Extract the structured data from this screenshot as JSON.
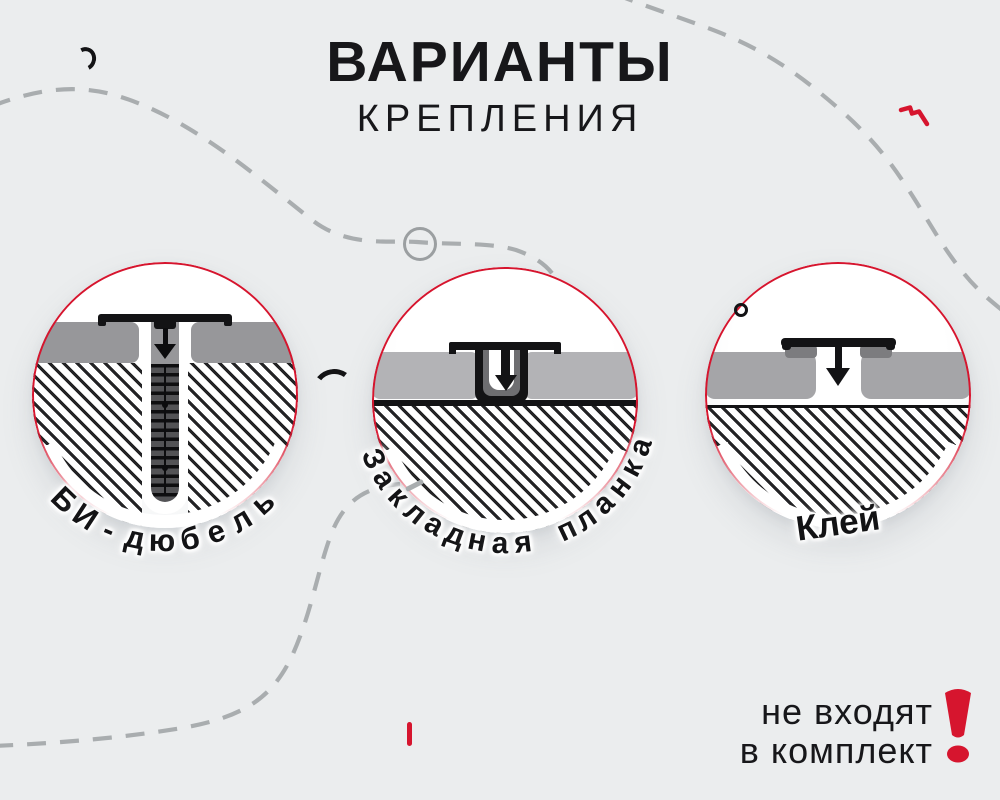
{
  "page": {
    "background": "#ebedee"
  },
  "colors": {
    "accent_red": "#d6152e",
    "ink": "#17171a",
    "dash_gray": "#a9adaf",
    "hatch_line": "#232325",
    "panel_gray_option1": "#97979a",
    "panel_gray_option2": "#b3b3b6",
    "panel_gray_option3": "#a5a5a8"
  },
  "title": {
    "line1": "ВАРИАНТЫ",
    "line2": "КРЕПЛЕНИЯ"
  },
  "options": [
    {
      "label": "БИ-дюбель",
      "icon": "bi-dowel-cross-section-diagram"
    },
    {
      "label": "Закладная планка",
      "icon": "embedded-plank-cross-section-diagram"
    },
    {
      "label": "Клей",
      "icon": "glue-cross-section-diagram"
    }
  ],
  "note": {
    "line1": "не входят",
    "line2": "в комплект"
  },
  "decorations": [
    "dashed-curve-top-left",
    "dashed-curve-top-right",
    "dashed-curve-bottom-left",
    "gray-circle-outline-marker",
    "black-arc-marker",
    "black-curl-marker",
    "black-ring-marker",
    "red-squiggle-marker",
    "red-tick-marker",
    "exclamation-mark"
  ]
}
